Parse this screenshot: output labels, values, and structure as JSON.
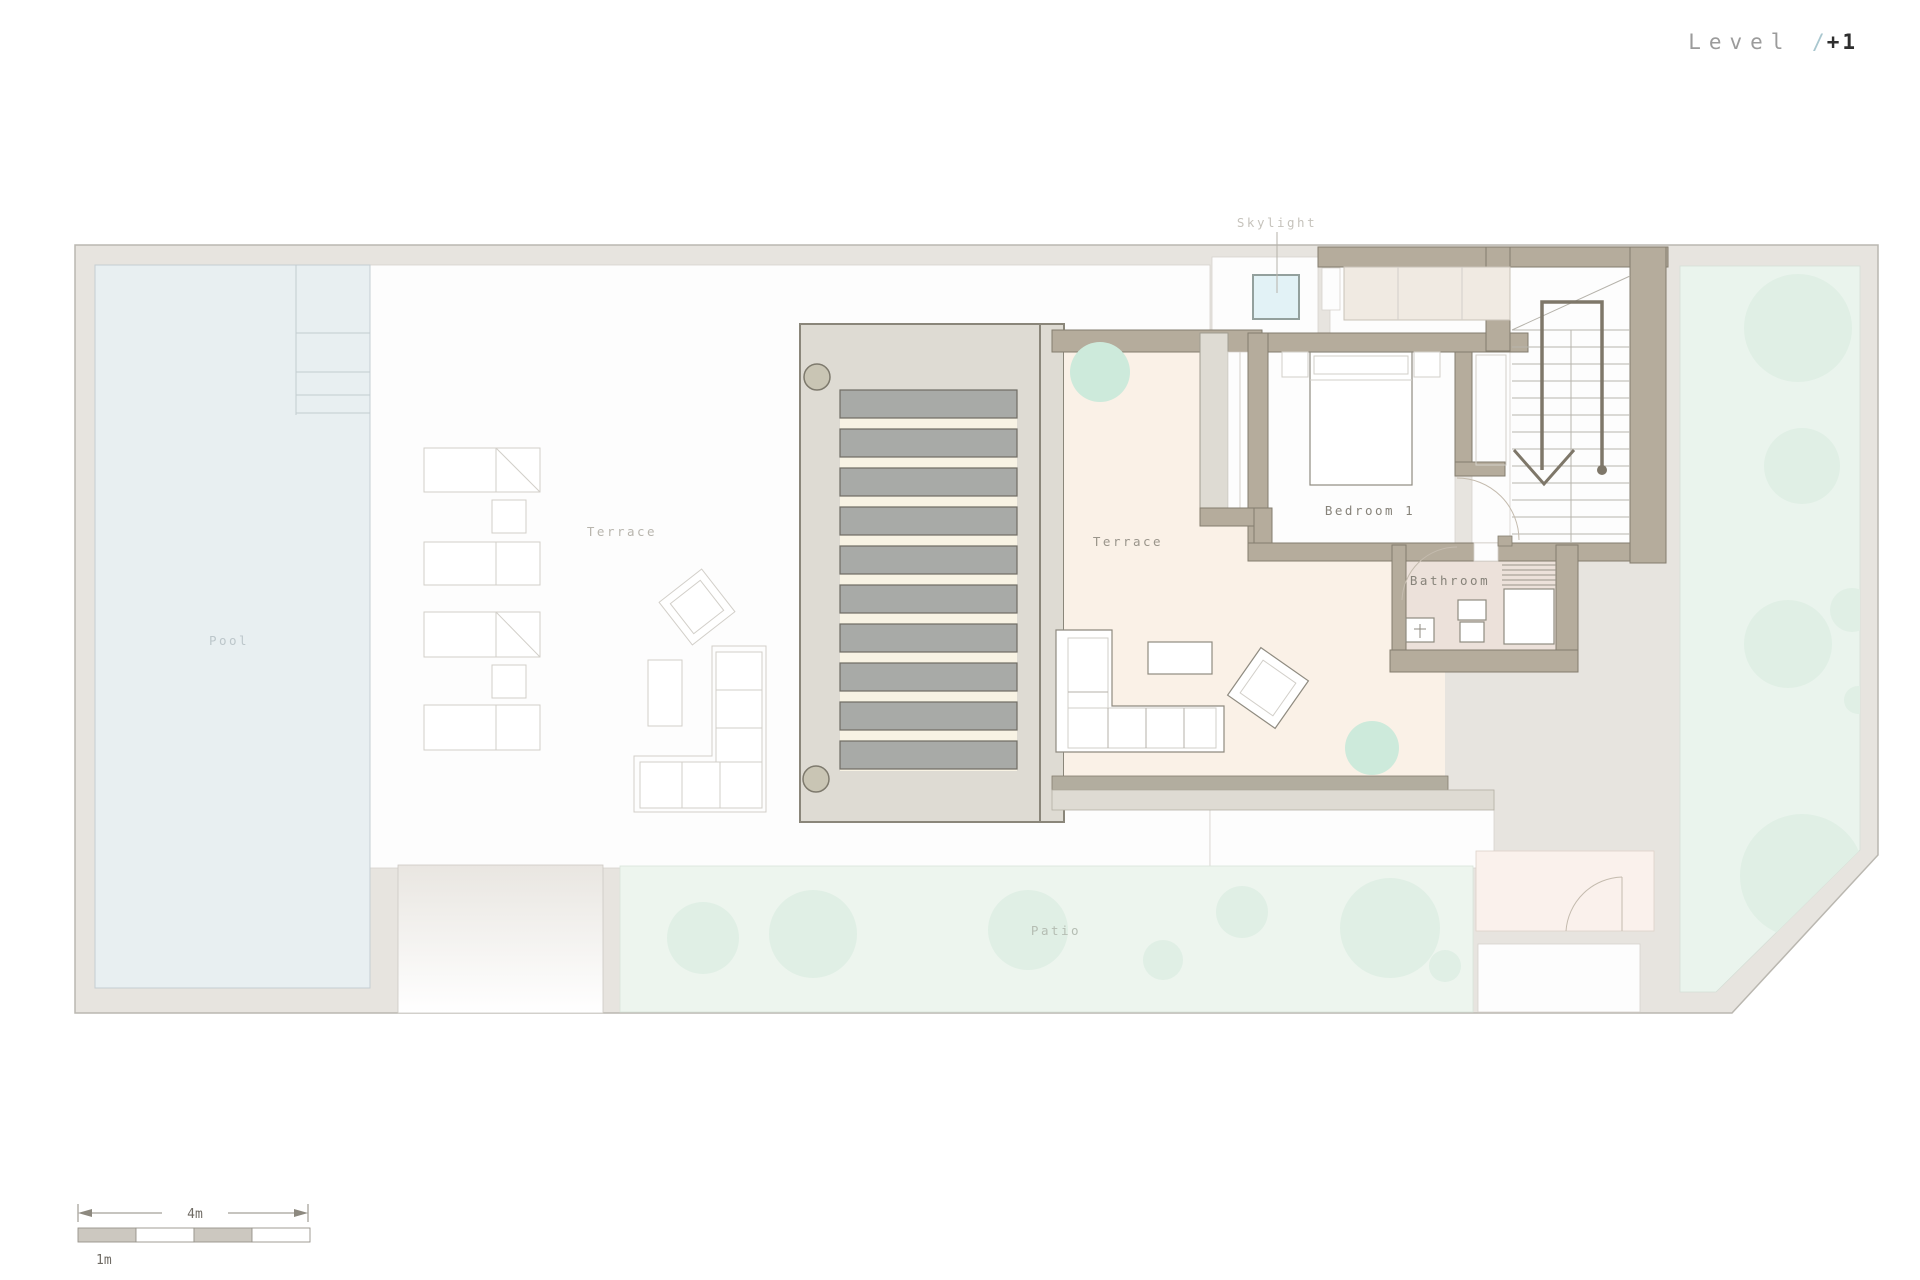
{
  "title": {
    "prefix": "Level ",
    "separator": "/",
    "number": "+1"
  },
  "rooms": {
    "pool": "Pool",
    "outdoor_terrace": "Terrace",
    "indoor_terrace": "Terrace",
    "bedroom": "Bedroom 1",
    "bathroom": "Bathroom",
    "patio": "Patio",
    "skylight": "Skylight"
  },
  "scale_bar": {
    "major_label": "4m",
    "minor_label": "1m"
  },
  "colors": {
    "boundary": "#e7e4df",
    "wall": "#b5ac9c",
    "wall-line": "#847d6e",
    "pool-blue": "#e8eff1",
    "cream": "#faf1e7",
    "pergola": "#dedbd3",
    "slat": "#a8aaa7",
    "slat-gap": "#f8f3e4",
    "patio-green": "#edf5ee",
    "garden-green": "#eaf4ed",
    "tree-green": "#e0efe5",
    "plant-green": "#cdeadb",
    "bath-floor": "#ece1da",
    "pink-room": "#faf1ec",
    "skylight-blue": "#e2f2f6",
    "white": "#fdfdfd",
    "title-gray": "#9b9b9b",
    "title-accent": "#a9c7cf",
    "title-dark": "#2e2e2e"
  }
}
